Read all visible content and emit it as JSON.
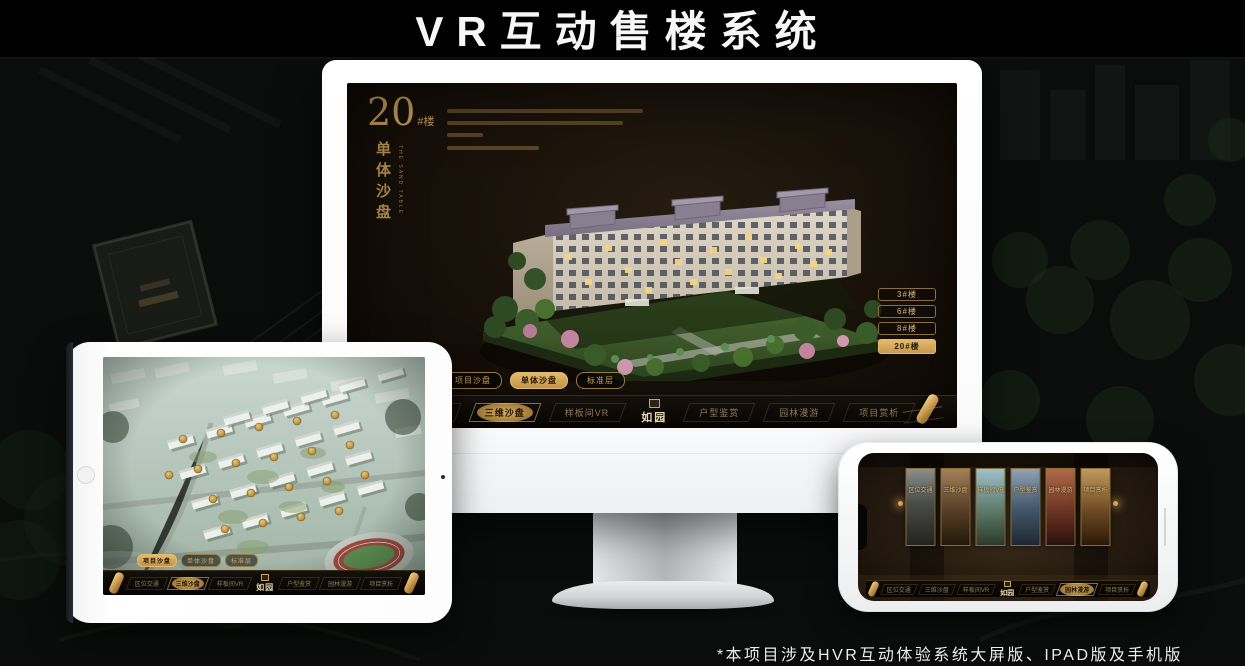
{
  "page": {
    "title": "VR互动售楼系统",
    "footnote": "*本项目涉及HVR互动体验系统大屏版、IPAD版及手机版"
  },
  "colors": {
    "gold": "#c9a257",
    "gold_bright": "#e3ba6b",
    "screen_bg": "#171009",
    "device_white": "#fdfdfd"
  },
  "nav": {
    "logo": "如园",
    "items": [
      {
        "label": "区位交通"
      },
      {
        "label": "三维沙盘"
      },
      {
        "label": "样板间VR"
      },
      {
        "label": "户型鉴赏"
      },
      {
        "label": "园林漫游"
      },
      {
        "label": "项目赏析"
      }
    ]
  },
  "monitor": {
    "headline_number": "20",
    "headline_suffix": "#楼",
    "section_title": "单体沙盘",
    "section_title_en": "THE SAND TABLE",
    "floor_buttons": [
      {
        "label": "3#楼",
        "active": false
      },
      {
        "label": "6#楼",
        "active": false
      },
      {
        "label": "8#楼",
        "active": false
      },
      {
        "label": "20#楼",
        "active": true
      }
    ],
    "subtabs": [
      {
        "label": "项目沙盘",
        "active": false
      },
      {
        "label": "单体沙盘",
        "active": true
      },
      {
        "label": "标准层",
        "active": false
      }
    ],
    "active_nav": "三维沙盘"
  },
  "tablet": {
    "subtabs": [
      {
        "label": "项目沙盘",
        "active": true
      },
      {
        "label": "单体沙盘",
        "active": false
      },
      {
        "label": "标准层",
        "active": false
      }
    ],
    "active_nav": "三维沙盘"
  },
  "phone": {
    "active_nav": "园林漫游",
    "cards": [
      "区位交通",
      "三维沙盘",
      "样板间VR",
      "户型鉴赏",
      "园林漫游",
      "项目赏析"
    ]
  }
}
